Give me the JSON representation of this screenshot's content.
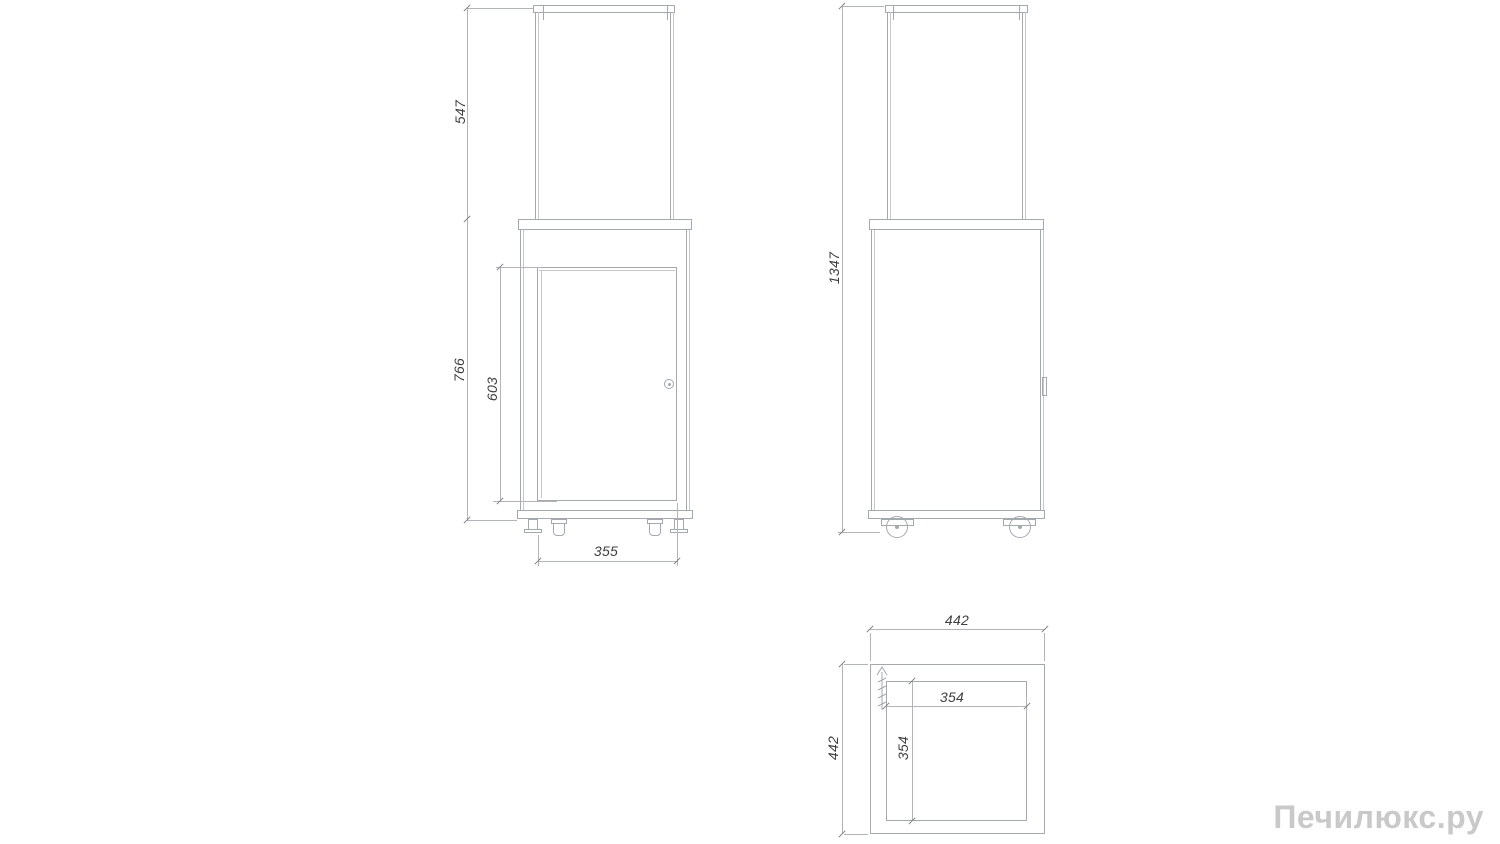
{
  "front_view": {
    "glass_height": "547",
    "body_height": "766",
    "door_height": "603",
    "width": "355"
  },
  "side_view": {
    "total_height": "1347"
  },
  "top_view": {
    "outer_width": "442",
    "outer_depth": "442",
    "inner_width": "354",
    "inner_depth": "354",
    "gas_inlet_icon": "hatched-arrow"
  },
  "watermark": "Печилюкс.ру",
  "colors": {
    "object_line": "#a4a9ae",
    "dimension_line": "#b2b5b8",
    "dimension_text": "#3f3f3f",
    "watermark": "#c9c9c9",
    "background": "#ffffff"
  }
}
